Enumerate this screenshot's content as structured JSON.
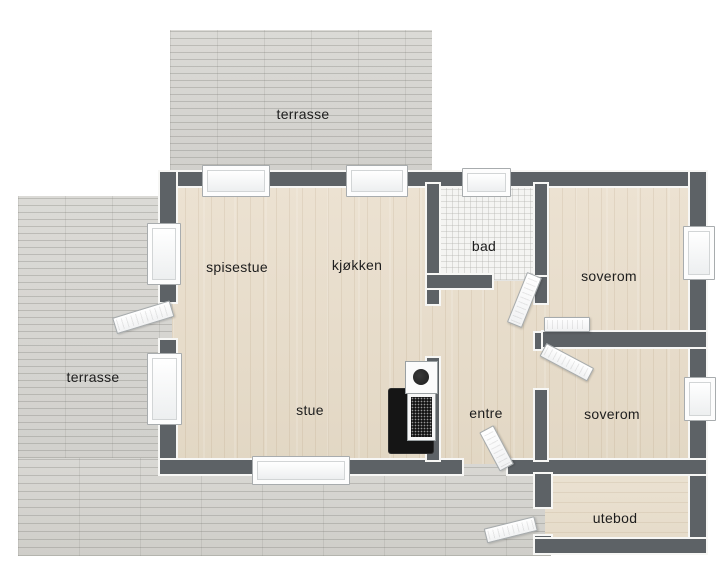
{
  "plan": {
    "type": "3d-floor-plan",
    "rooms": [
      {
        "id": "terrasse-top",
        "label": "terrasse"
      },
      {
        "id": "terrasse-left",
        "label": "terrasse"
      },
      {
        "id": "spisestue",
        "label": "spisestue"
      },
      {
        "id": "kjokken",
        "label": "kjøkken"
      },
      {
        "id": "bad",
        "label": "bad"
      },
      {
        "id": "soverom-top",
        "label": "soverom"
      },
      {
        "id": "stue",
        "label": "stue"
      },
      {
        "id": "entre",
        "label": "entre"
      },
      {
        "id": "soverom-bottom",
        "label": "soverom"
      },
      {
        "id": "utebod",
        "label": "utebod"
      }
    ]
  },
  "colors": {
    "wall": "#5d6266",
    "deck": "#d6d5d1",
    "wood": "#e7ddcc",
    "tile": "#f4f4f2",
    "label_ink": "#1d1d1d"
  }
}
